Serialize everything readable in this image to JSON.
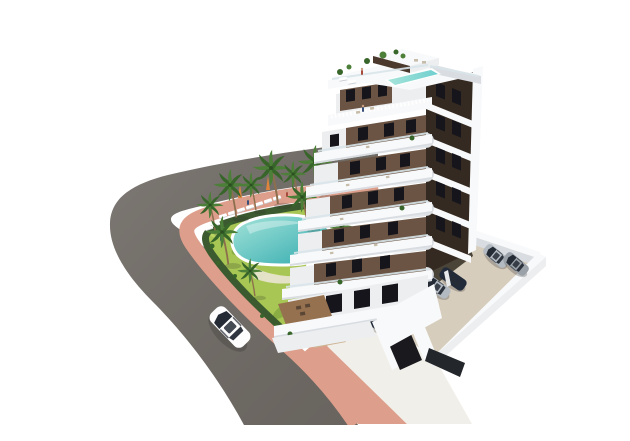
{
  "scene": {
    "description": "Aerial 3D architectural render of a modern white apartment tower with dark brown facade panels, wrap-around curved white balconies and a rooftop lap pool, set on a landscaped plot with a kidney-shaped swimming pool, sun loungers, palm trees, a curving asphalt road with a pink sidewalk, a white car driving on the road, and a walled beige parking lot with parked cars and a garage ramp.",
    "background": "plain white",
    "building": {
      "floors_visible": 7,
      "style": "white curved balcony bands over dark brown walls",
      "rooftop": [
        "lap pool",
        "glass railing",
        "planters",
        "stair bulkhead",
        "loungers"
      ],
      "ground_floor": [
        "wood deck terraces",
        "outdoor furniture",
        "planters"
      ]
    },
    "garden": {
      "pool": "kidney-shaped turquoise pool",
      "sun_loungers": 9,
      "parasols": 2,
      "palm_trees": 10,
      "hedge": "dark green hedge along sidewalk",
      "people": 3
    },
    "street": {
      "road": "curved grey asphalt, no markings",
      "sidewalk": "pink/salmon paved band",
      "moving_vehicles": 1,
      "moving_vehicle_color": "white"
    },
    "parking": {
      "surface": "beige concrete",
      "perimeter": "low white walls",
      "covered_cars": 6,
      "open_cars": 2,
      "garage_ramp": "dark ramp with white side walls and dark gates"
    }
  },
  "colors": {
    "white": "#f8f9fa",
    "white-shade": "#d9dde2",
    "white-dim": "#eceef0",
    "rail": "#d8e4ea",
    "brown": "#6b5443",
    "brown-mid": "#4a392c",
    "brown-dark": "#352a21",
    "window": "#15151b",
    "road": "#6f6a64",
    "walk": "#dd9f8c",
    "lawn": "#a8c653",
    "lawn-dark": "#7da43f",
    "lawn-light": "#c2da69",
    "hedge": "#3c5a2f",
    "pool-light": "#a5e4da",
    "pool-deep": "#2fa9ad",
    "palm": "#4c7f38",
    "palm-dark": "#38652a",
    "trunk": "#8d6f4e",
    "beige": "#d7cdbc",
    "undercroft": "#4a4438",
    "column": "#e8e9ea",
    "car-white": "#fdfdfd",
    "car-dark": "#222b3a",
    "car-silver": "#b3bac1",
    "glass": "#252b35",
    "wood": "#96714f",
    "wood-dark": "#5a4634",
    "deck-terra": "#cdb493",
    "deck-pale": "#e9e4d4",
    "ramp": "#1a1a1e",
    "gate": "#23262b",
    "driveway": "#f1efe9",
    "furniture": "#c6bca9",
    "shadow": "rgba(40,40,40,0.25)",
    "umbrella": "#e0843c",
    "skin": "#caa184",
    "person-a": "#3a4f7a",
    "person-b": "#a84b3c"
  }
}
